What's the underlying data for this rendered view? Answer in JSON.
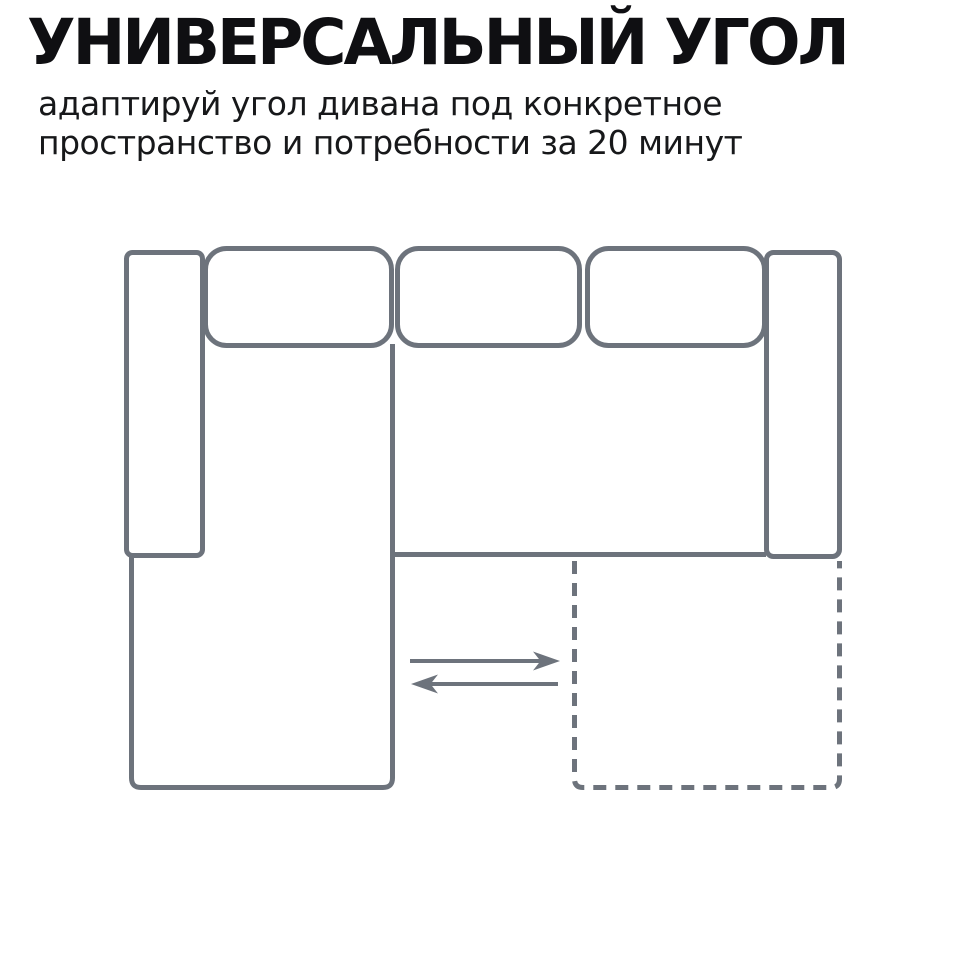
{
  "page": {
    "background_color": "#ffffff"
  },
  "header": {
    "title": "УНИВЕРСАЛЬНЫЙ УГОЛ",
    "title_color": "#0f0f12",
    "subtitle_lines": [
      "адаптируй угол дивана под конкретное",
      "пространство и потребности за 20 минут"
    ],
    "subtitle_color": "#17181a"
  },
  "diagram": {
    "kind": "sofa-top-view-schematic",
    "stroke_color": "#6d737c",
    "solid_parts": [
      "left-armrest",
      "chaise-section",
      "back-cushion-1",
      "back-cushion-2",
      "back-cushion-3",
      "seat-front-edge",
      "right-armrest"
    ],
    "dashed_parts": [
      "movable-corner-alternate-position"
    ],
    "arrows": [
      "swap-arrow-right",
      "swap-arrow-left"
    ]
  }
}
